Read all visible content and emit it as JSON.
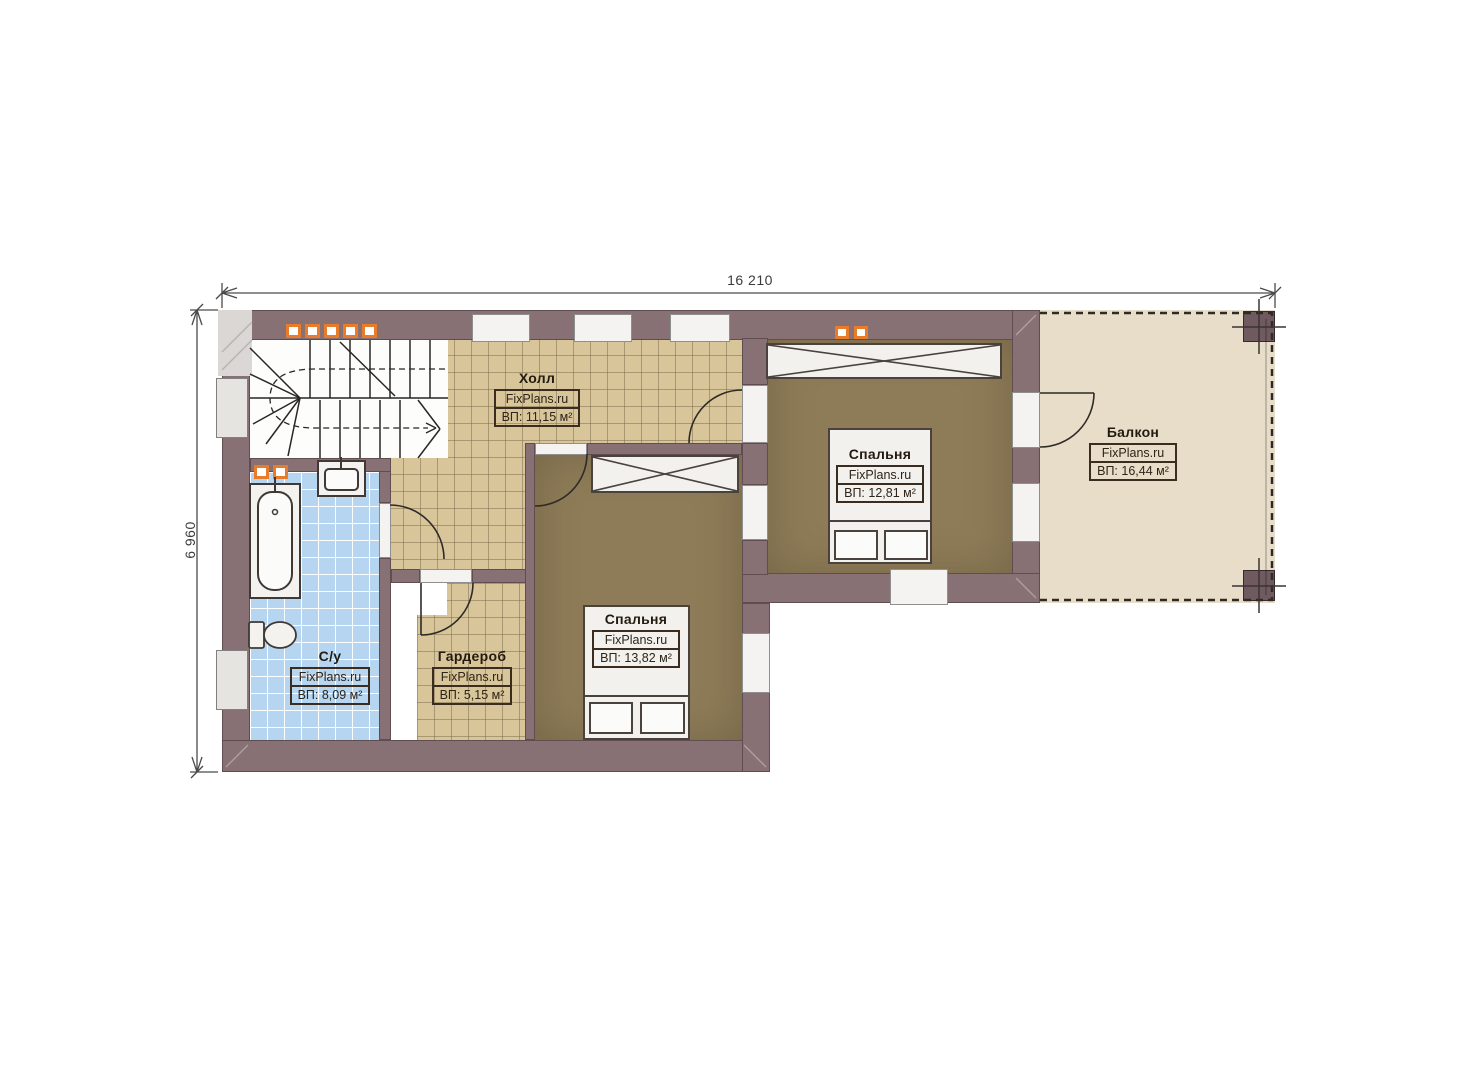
{
  "watermark": "FixPlans.ru",
  "dimensions": {
    "top": "16 210",
    "left": "6 960"
  },
  "rooms": {
    "hall": {
      "name": "Холл",
      "area": "ВП: 11,15 м²"
    },
    "bathroom": {
      "name": "С/у",
      "area": "ВП: 8,09 м²"
    },
    "wardrobe": {
      "name": "Гардероб",
      "area": "ВП: 5,15 м²"
    },
    "bedroom_lower": {
      "name": "Спальня",
      "area": "ВП: 13,82 м²"
    },
    "bedroom_upper": {
      "name": "Спальня",
      "area": "ВП: 12,81 м²"
    },
    "balcony": {
      "name": "Балкон",
      "area": "ВП: 16,44 м²"
    }
  },
  "colors": {
    "wall": "#877174",
    "tile_tan": "#d8c59a",
    "tile_blue": "#b5d5f1",
    "floor_brown": "#8e7c58",
    "balcony_floor": "#e8ddc8",
    "window_accent": "#e87c2a"
  }
}
